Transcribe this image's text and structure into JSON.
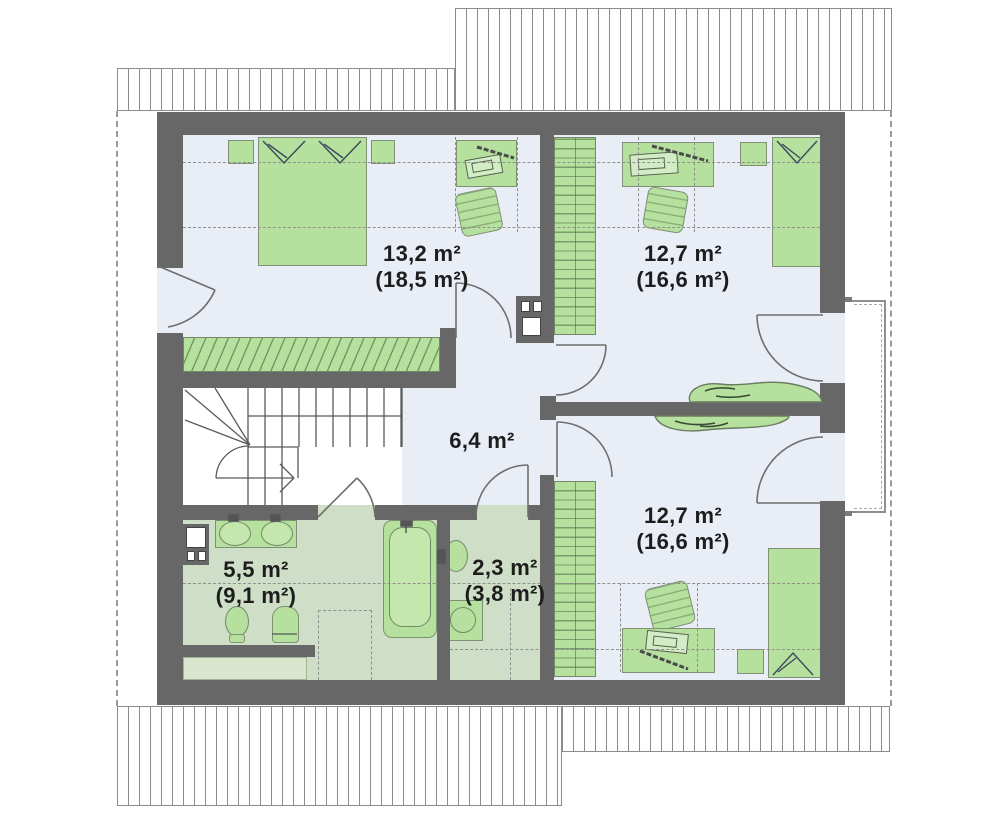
{
  "rooms": {
    "bedroom1": {
      "area": "13,2 m²",
      "floor_area": "(18,5 m²)"
    },
    "bedroom2": {
      "area": "12,7 m²",
      "floor_area": "(16,6 m²)"
    },
    "bedroom3": {
      "area": "12,7 m²",
      "floor_area": "(16,6 m²)"
    },
    "hall": {
      "area": "6,4 m²"
    },
    "bathroom": {
      "area": "5,5 m²",
      "floor_area": "(9,1 m²)"
    },
    "wc": {
      "area": "2,3 m²",
      "floor_area": "(3,8 m²)"
    }
  },
  "colors": {
    "wall": "#676767",
    "room_floor": "#e9edf6",
    "wet_room_floor": "#cfdec6",
    "furniture": "#b5e09e",
    "dashed_line": "#8f8f8f",
    "label_text": "#1d1d1d"
  }
}
